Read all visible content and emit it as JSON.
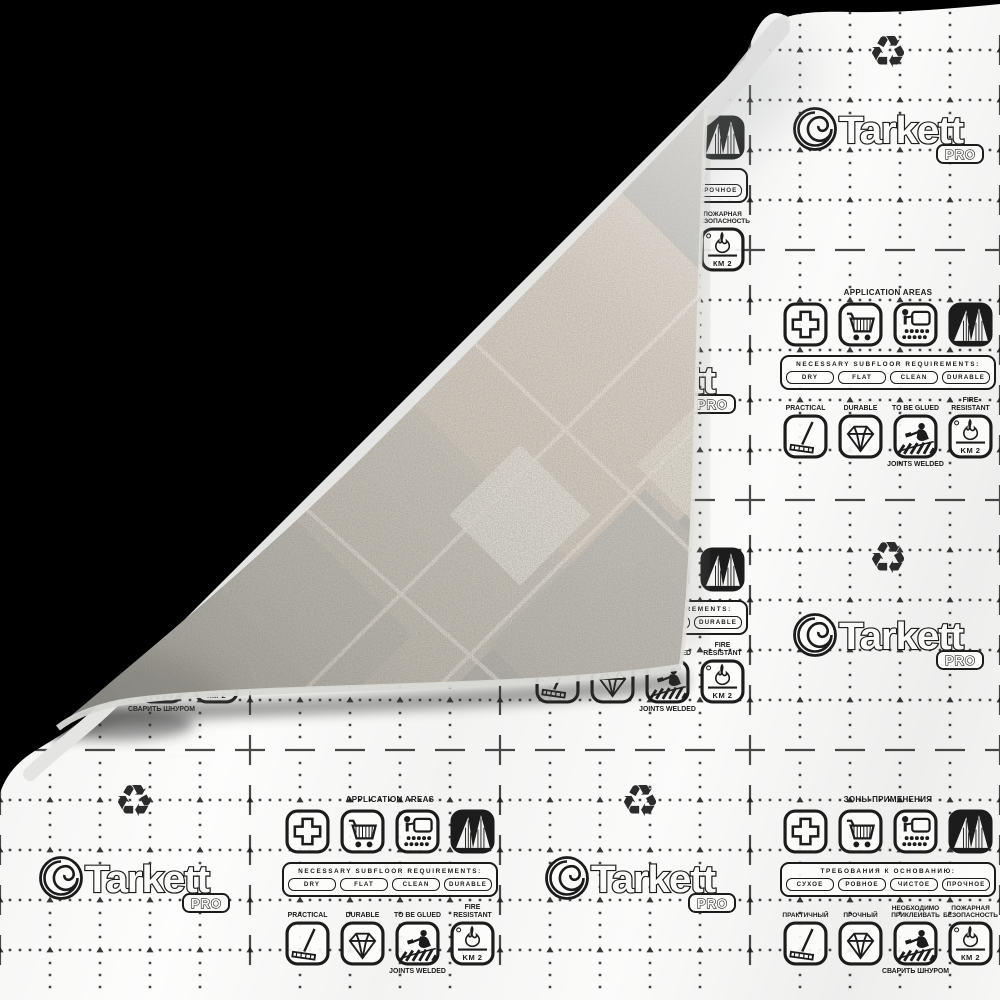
{
  "product": {
    "brand": "Tarkett",
    "badge": "PRO"
  },
  "symbols": {
    "recycling_glyph": "♻"
  },
  "panel_en": {
    "application_title": "APPLICATION AREAS",
    "area_icons": [
      "medical-cross-icon",
      "shopping-cart-icon",
      "presentation-board-icon",
      "buildings-icon"
    ],
    "requirements_title": "NECESSARY SUBFLOOR REQUIREMENTS:",
    "requirements": [
      "DRY",
      "FLAT",
      "CLEAN",
      "DURABLE"
    ],
    "features": [
      {
        "label": "PRACTICAL",
        "icon": "mop-icon"
      },
      {
        "label": "DURABLE",
        "icon": "diamond-icon"
      },
      {
        "label": "TO BE GLUED",
        "icon": "glue-trowel-icon",
        "sublabel": "JOINTS WELDED"
      },
      {
        "label": "FIRE RESISTANT",
        "icon": "flame-icon",
        "km_label": "KM 2"
      }
    ]
  },
  "panel_ru": {
    "application_title": "ЗОНЫ ПРИМЕНЕНИЯ",
    "area_icons": [
      "medical-cross-icon",
      "shopping-cart-icon",
      "presentation-board-icon",
      "buildings-icon"
    ],
    "requirements_title": "ТРЕБОВАНИЯ К ОСНОВАНИЮ:",
    "requirements": [
      "СУХОЕ",
      "РОВНОЕ",
      "ЧИСТОЕ",
      "ПРОЧНОЕ"
    ],
    "features": [
      {
        "label": "ПРАКТИЧНЫЙ",
        "icon": "mop-icon"
      },
      {
        "label": "ПРОЧНЫЙ",
        "icon": "diamond-icon"
      },
      {
        "label": "НЕОБХОДИМО ПРИКЛЕИВАТЬ",
        "icon": "glue-trowel-icon",
        "sublabel": "СВАРИТЬ ШНУРОМ"
      },
      {
        "label": "ПОЖАРНАЯ БЕЗОПАСНОСТЬ",
        "icon": "flame-icon",
        "km_label": "КМ 2"
      }
    ]
  },
  "colors": {
    "print": "#1c1c1c",
    "backdrop": "#000000",
    "sheet": "#f4f4f3",
    "terrazzo_base": "#b9b6b0",
    "terrazzo_beige": "#d6ccbe"
  }
}
